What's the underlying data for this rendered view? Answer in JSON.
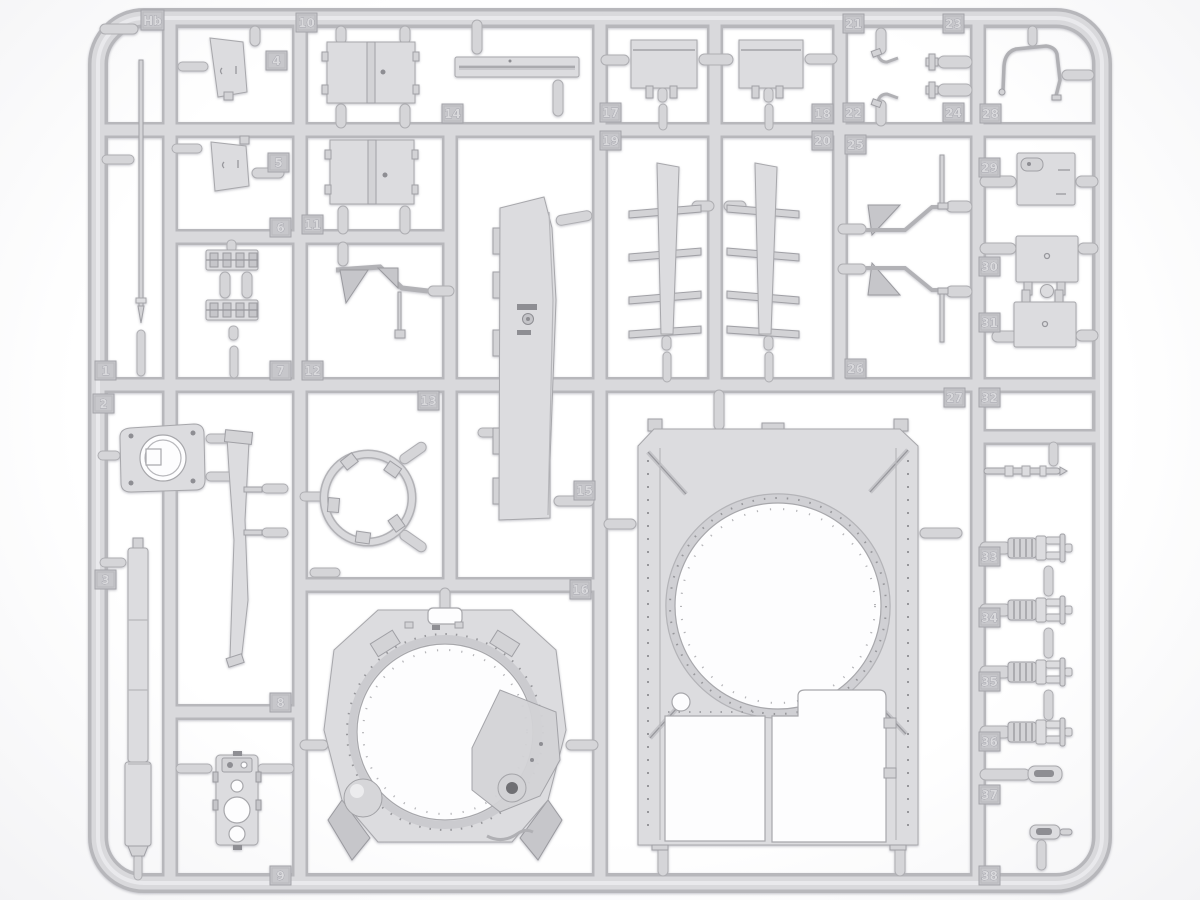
{
  "sprue": {
    "tags": {
      "hb": "Hb",
      "n1": "1",
      "n2": "2",
      "n3": "3",
      "n4": "4",
      "n5": "5",
      "n6": "6",
      "n7": "7",
      "n8": "8",
      "n9": "9",
      "n10": "10",
      "n11": "11",
      "n12": "12",
      "n13": "13",
      "n14": "14",
      "n15": "15",
      "n16": "16",
      "n17": "17",
      "n18": "18",
      "n19": "19",
      "n20": "20",
      "n21": "21",
      "n22": "22",
      "n23": "23",
      "n24": "24",
      "n25": "25",
      "n26": "26",
      "n27": "27",
      "n28": "28",
      "n29": "29",
      "n30": "30",
      "n31": "31",
      "n32": "32",
      "n33": "33",
      "n34": "34",
      "n35": "35",
      "n36": "36",
      "n37": "37",
      "n38": "38"
    }
  },
  "colors": {
    "background": "#ffffff",
    "runner_edge": "#b7b7bb",
    "runner_core": "#d9d9dc",
    "part_fill": "#dcdcdf",
    "part_stroke": "#a7a7ab",
    "tag_fill": "#c7c7cb",
    "tag_text": "#d9d9dc",
    "hole_fill": "#fdfdfe",
    "detail_dark": "#8e8e93"
  }
}
